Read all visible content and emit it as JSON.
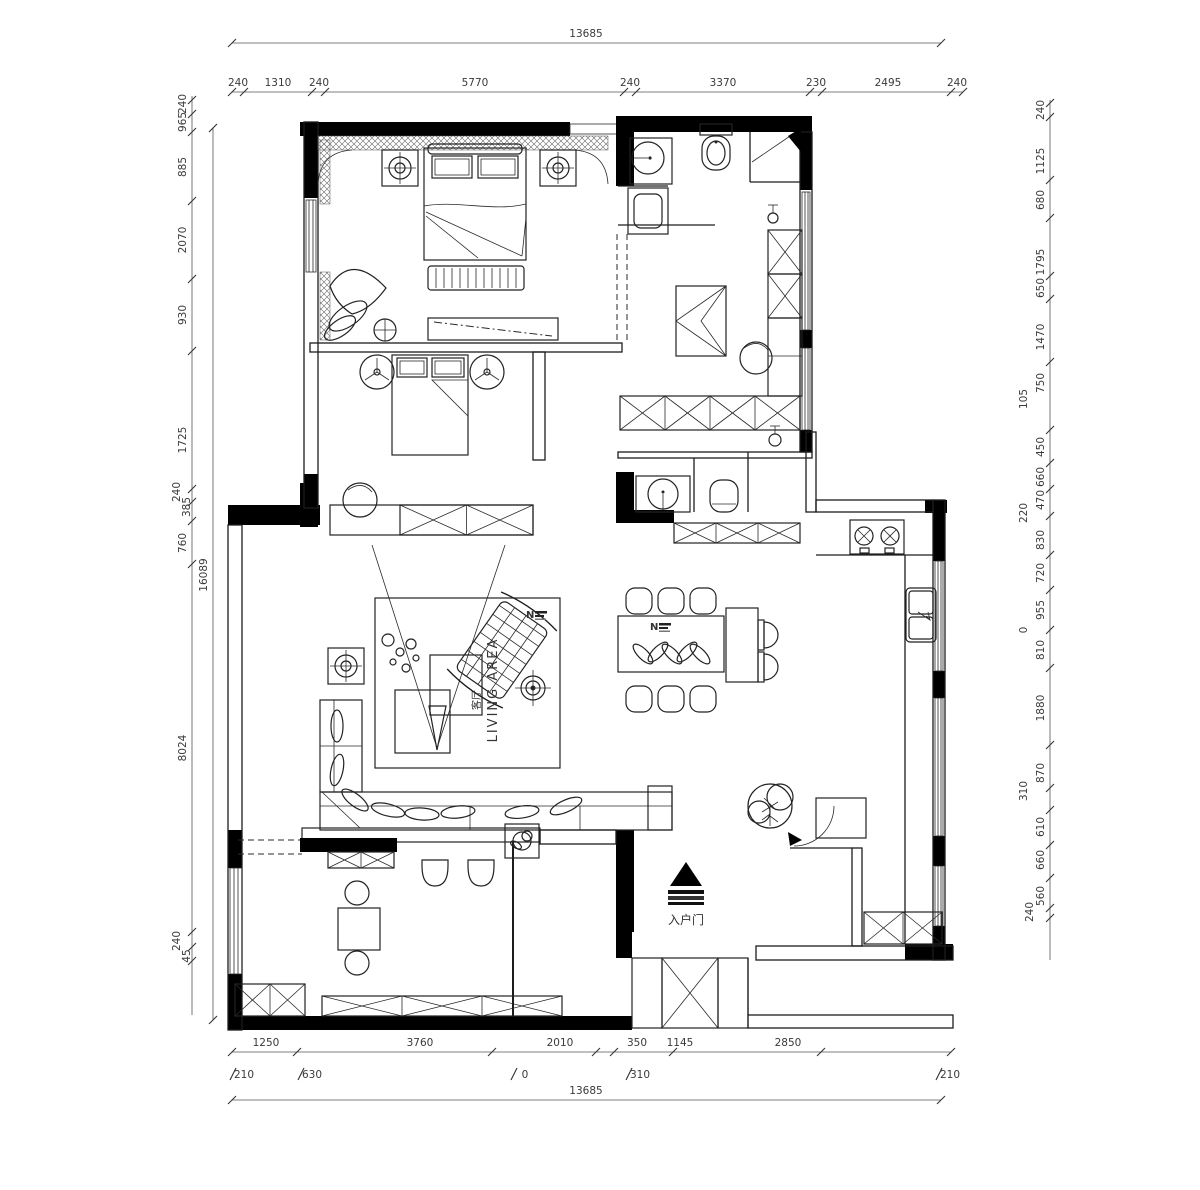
{
  "labels": {
    "living_area_en": "LIVING AREA",
    "living_area_cn": "客厅",
    "entry_door": "入户门",
    "north_mark": "N"
  },
  "dimensions": {
    "top_total": "13685",
    "top_row": [
      "240",
      "1310",
      "240",
      "5770",
      "240",
      "3370",
      "230",
      "2495",
      "240"
    ],
    "bottom_row": [
      "1250",
      "3760",
      "2010",
      "350",
      "1145",
      "2850"
    ],
    "bottom_sub": [
      "210",
      "630",
      "0",
      "310",
      "210"
    ],
    "bottom_total": "13685",
    "left_col": [
      "240",
      "965",
      "885",
      "2070",
      "930",
      "1725",
      "240",
      "385",
      "760",
      "8024",
      "240",
      "45"
    ],
    "left_total": "16089",
    "right_col": [
      "240",
      "1125",
      "680",
      "1795",
      "650",
      "1470",
      "750",
      "105",
      "450",
      "660",
      "470",
      "220",
      "830",
      "720",
      "955",
      "0",
      "810",
      "1880",
      "870",
      "310",
      "610",
      "660",
      "560",
      "240"
    ]
  }
}
